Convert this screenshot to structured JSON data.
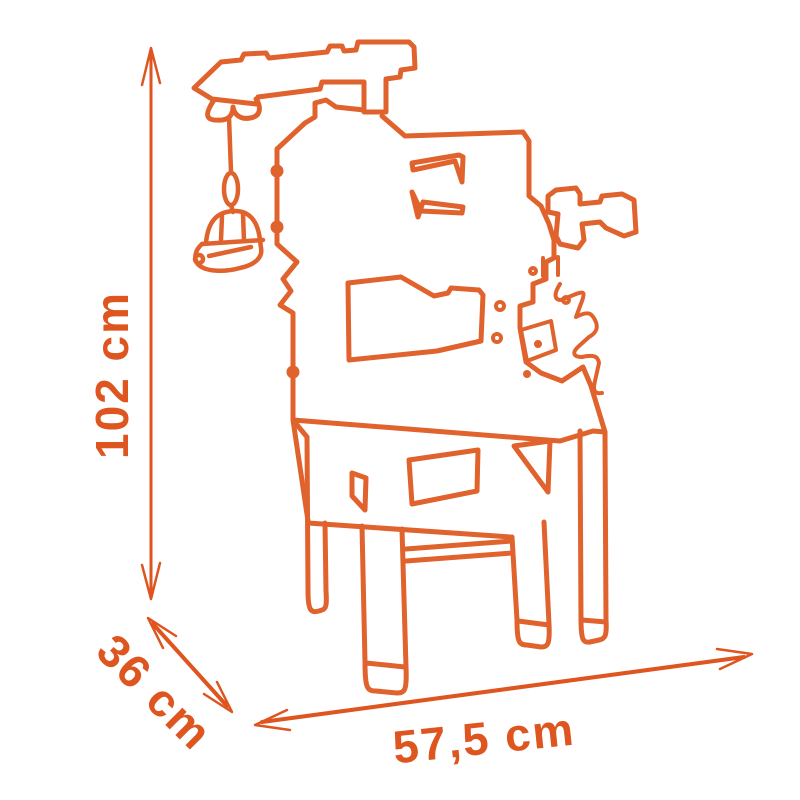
{
  "diagram": {
    "subject": "Toy workbench with crane - outline dimension drawing",
    "outline_color": "#E0622D",
    "accent_color": "#DE5520",
    "background_color": "#FFFFFF",
    "dimensions": [
      {
        "id": "height",
        "label": "102 cm",
        "orientation": "vertical"
      },
      {
        "id": "depth",
        "label": "36 cm",
        "orientation": "diagonal"
      },
      {
        "id": "width",
        "label": "57,5 cm",
        "orientation": "horizontal"
      }
    ]
  }
}
